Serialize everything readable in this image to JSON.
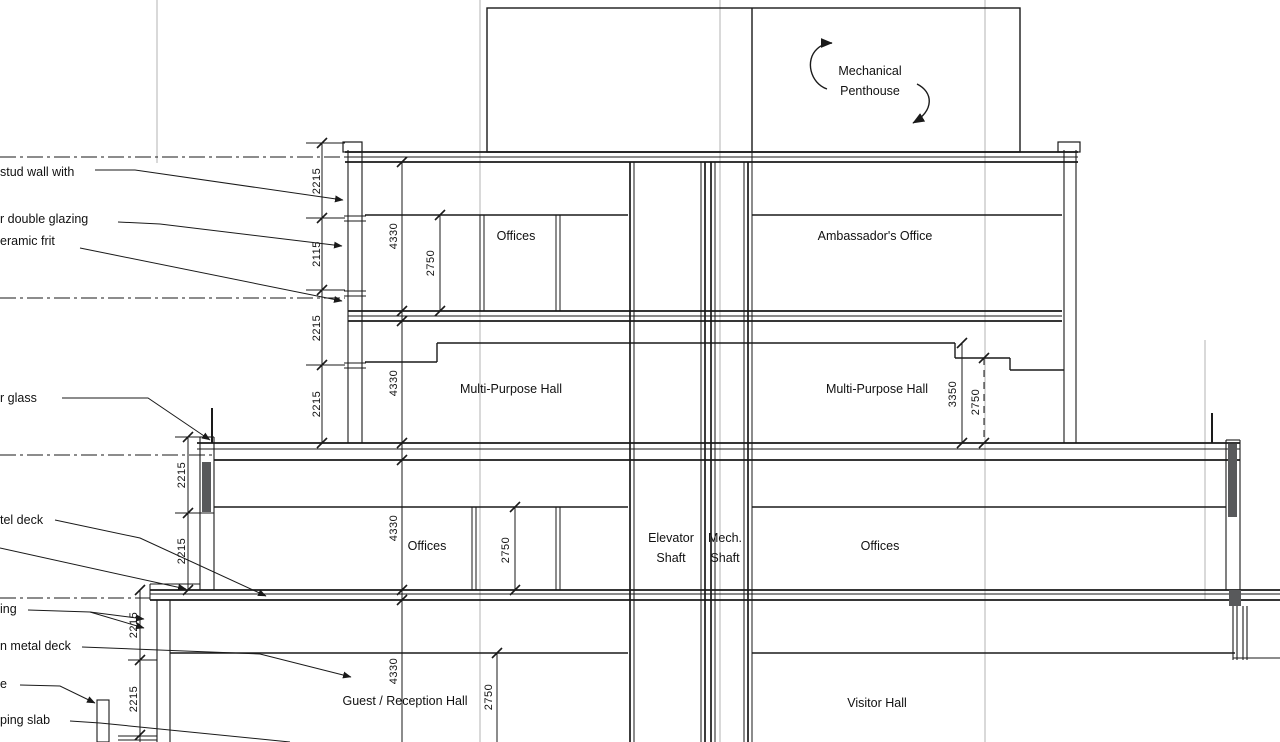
{
  "rooms": {
    "penthouse": "Mechanical Penthouse",
    "offices_top": "Offices",
    "ambassador": "Ambassador's Office",
    "mph_left": "Multi-Purpose Hall",
    "mph_right": "Multi-Purpose Hall",
    "elevator_shaft": "Elevator Shaft",
    "mech_shaft": "Mech. Shaft",
    "offices_mid_left": "Offices",
    "offices_mid_right": "Offices",
    "guest_hall": "Guest / Reception Hall",
    "visitor_hall": "Visitor Hall"
  },
  "notes": {
    "n1": "stud wall with",
    "n2": "r double glazing",
    "n3": "eramic frit",
    "n4": "r glass",
    "n5": "tel deck",
    "n6": "ing",
    "n7": "n metal deck",
    "n8": "e",
    "n9": "ping slab"
  },
  "dims": {
    "top_chain": [
      "2215",
      "2115",
      "2215",
      "2215"
    ],
    "mid_chain": [
      "2215",
      "2215"
    ],
    "bottom_chain": [
      "2215",
      "2215"
    ],
    "l4_floor": "4330",
    "l4_clear": "2750",
    "l3_floor": "4330",
    "l2_floor": "4330",
    "l2_clear": "2750",
    "l1_floor": "4330",
    "l1_clear": "2750",
    "mph_high": "3350",
    "mph_low": "2750"
  },
  "colors": {
    "line": "#1a1a1a",
    "grid": "#b3b3b3",
    "solid_fill": "#58595b",
    "background": "#ffffff"
  }
}
